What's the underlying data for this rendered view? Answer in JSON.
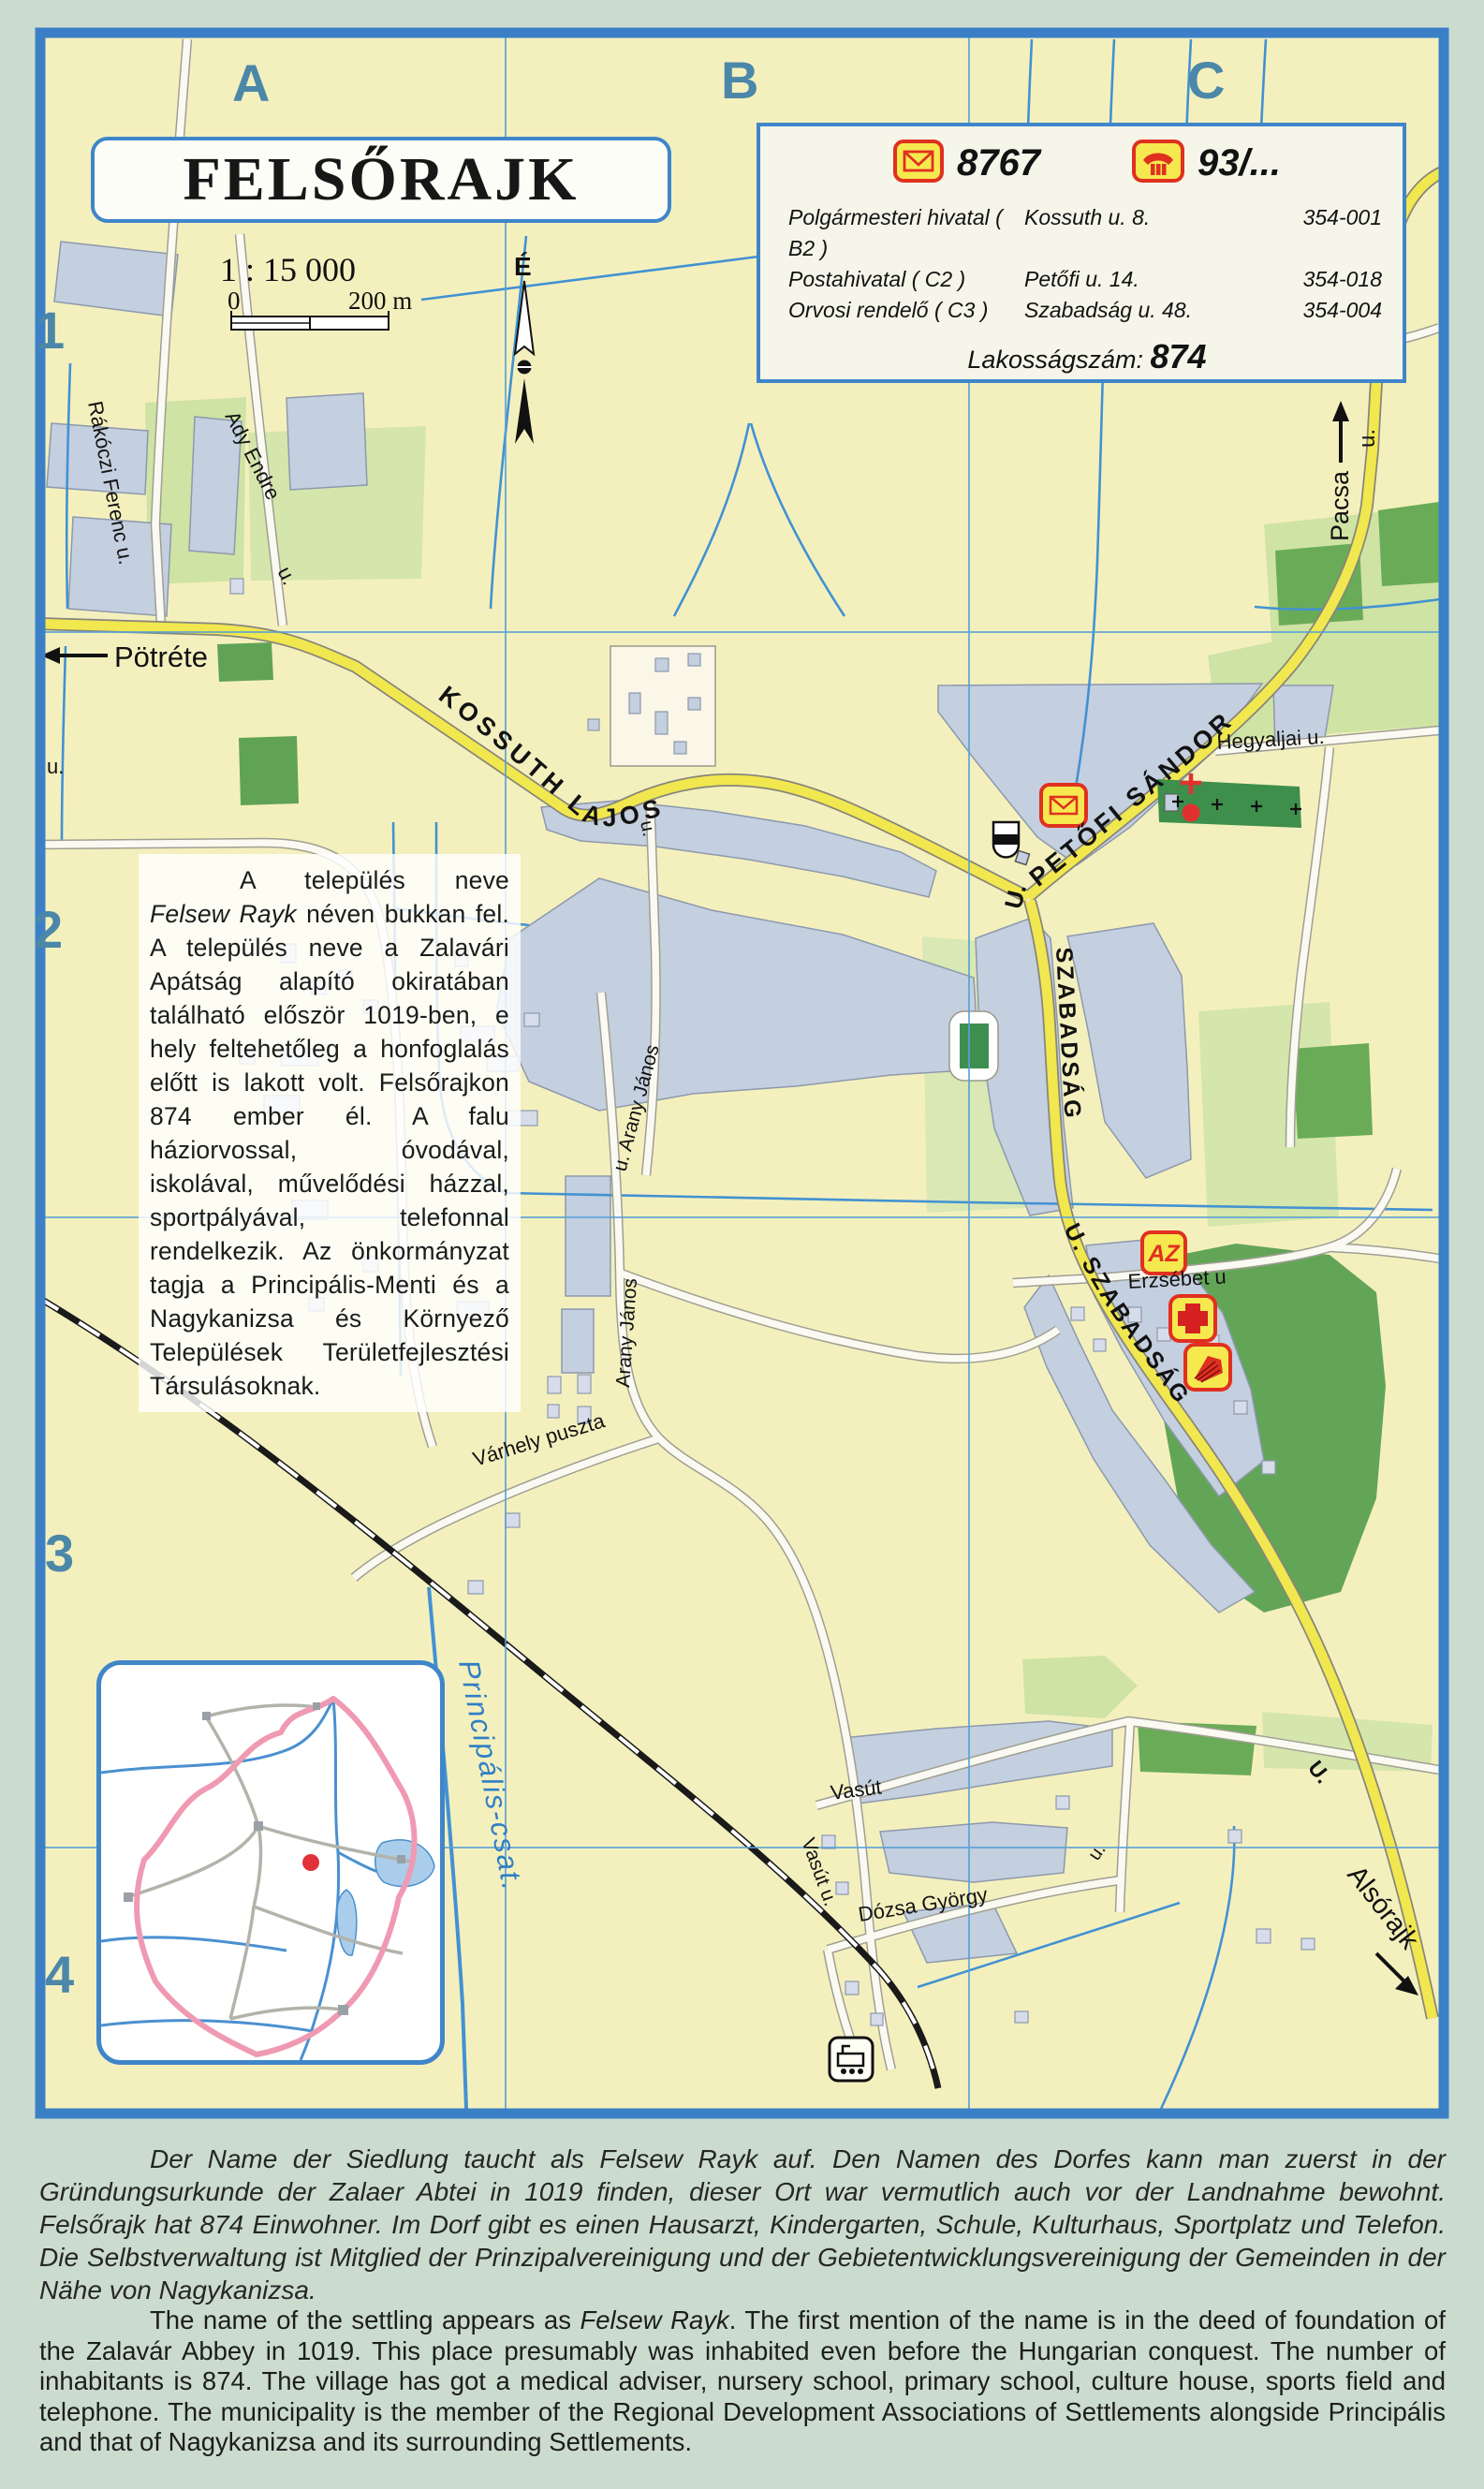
{
  "map": {
    "title": "FELSŐRAJK",
    "scale": {
      "ratio": "1 : 15 000",
      "zero": "0",
      "max": "200 m"
    },
    "north": "É",
    "grid": {
      "columns": [
        "A",
        "B",
        "C"
      ],
      "rows": [
        "1",
        "2",
        "3",
        "4"
      ]
    },
    "info_box": {
      "postal_code": "8767",
      "phone_code": "93/...",
      "entries": [
        {
          "name": "Polgármesteri hivatal ( B2 )",
          "address": "Kossuth u. 8.",
          "phone": "354-001"
        },
        {
          "name": "Postahivatal ( C2 )",
          "address": "Petőfi u. 14.",
          "phone": "354-018"
        },
        {
          "name": "Orvosi rendelő ( C3 )",
          "address": "Szabadság u. 48.",
          "phone": "354-004"
        }
      ],
      "population_label": "Lakosságszám:",
      "population": "874"
    },
    "description": {
      "lead": "A település neve ",
      "name_italic": "Felsew Rayk",
      "body": " néven bukkan fel. A település neve a Zalavári Apátság alapító okiratában található először 1019-ben, e hely feltehetőleg a honfoglalás előtt is lakott volt. Felsőrajkon 874 ember él. A falu háziorvossal, óvodával, iskolával, művelődési házzal, sportpályával, telefonnal rendelkezik. Az önkormányzat tagja a Principális-Menti és a Nagykanizsa és Környező Települések Területfejlesztési Társulásoknak."
    },
    "streets": {
      "kossuth": "KOSSUTH LAJOS",
      "petofi": "PETŐFI SÁNDOR",
      "petofi_u": "U.",
      "szabadsag_north": "SZABADSÁG",
      "szabadsag_south": "U.  SZABADSÁG",
      "hegyaljai": "Hegyaljai u.",
      "erzsebet": "Erzsébet u",
      "arany_north": "u. Arany János",
      "arany_south": "Arany János",
      "varhely": "Várhely puszta",
      "vasut": "Vasút",
      "vasut_u": "Vasút  u.",
      "dozsa": "Dózsa György",
      "rakoczi": "Rákóczi Ferenc  u.",
      "ady": "Ady Endre",
      "ady_u": "u.",
      "u_left": "u.",
      "u_village": "u.",
      "u_dozsa": "u.",
      "u_alsorajk": "U."
    },
    "directions": {
      "west": "Pötréte",
      "north": "Pacsa",
      "north_u": "u.",
      "south": "Alsórajk"
    },
    "water": {
      "canal": "Principális-csat."
    },
    "icons": {
      "az": "AZ"
    }
  },
  "texts": {
    "german": "Der Name  der Siedlung taucht als Felsew Rayk auf. Den Namen des Dorfes kann man zuerst in der Gründungsurkunde der Zalaer Abtei in 1019 finden, dieser Ort war vermutlich auch vor der Landnahme bewohnt. Felsőrajk hat 874 Einwohner. Im Dorf gibt es einen Hausarzt, Kindergarten, Schule, Kulturhaus,  Sportplatz und Telefon. Die Selbstverwaltung ist Mitglied der Prinzipalvereinigung und der Gebietentwicklungsvereinigung der Gemeinden in der Nähe von Nagykanizsa.",
    "english": {
      "lead": "The name of the settling appears as ",
      "name_italic": "Felsew Rayk",
      "body": ". The first mention of the name is in the deed of foundation of the Zalavár Abbey in 1019. This place presumably was inhabited even before the Hungarian conquest. The number of inhabitants is 874. The village has got a medical adviser, nursery school, primary school, culture house, sports field and telephone. The municipality is the member of the Regional Development Associations of Settlements alongside Principális and that of Nagykanizsa and its surrounding Settlements."
    }
  },
  "colors": {
    "frame": "#3b80c6",
    "road_main": "#f1e74f",
    "water": "#4292d2",
    "accent_red": "#e03020",
    "grid_label": "#4b87a8"
  }
}
